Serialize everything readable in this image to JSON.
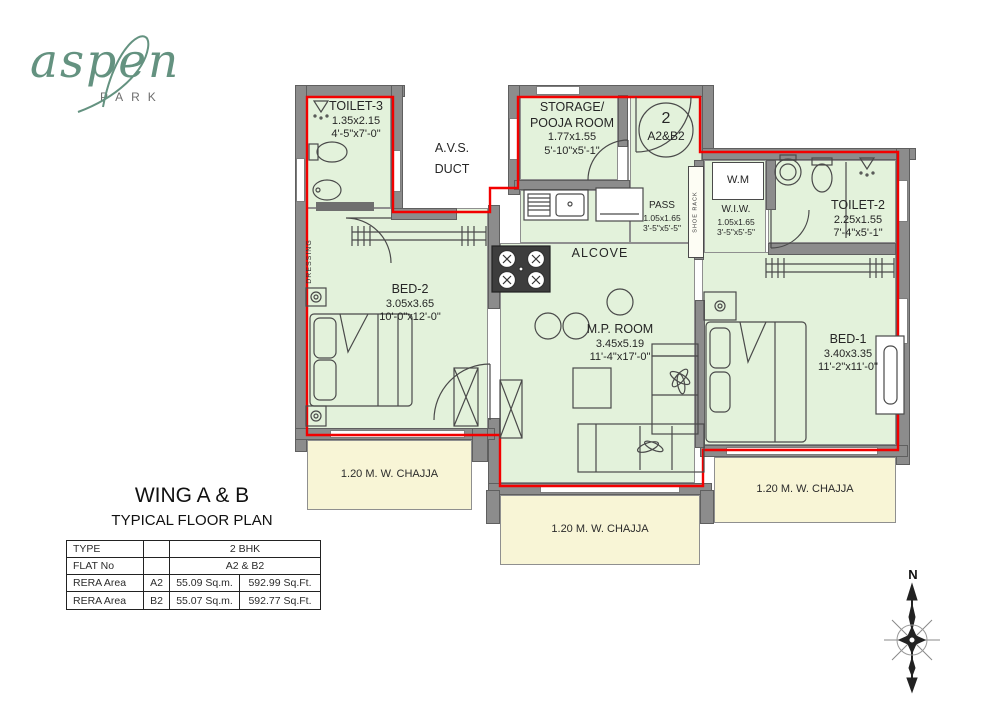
{
  "logo": {
    "brand": "aspen",
    "sub": "PARK"
  },
  "plan": {
    "toilet3": {
      "name": "TOILET-3",
      "m": "1.35x2.15",
      "ft": "4'-5\"x7'-0\""
    },
    "duct": {
      "l1": "A.V.S.",
      "l2": "DUCT"
    },
    "storage": {
      "l1": "STORAGE/",
      "l2": "POOJA ROOM",
      "m": "1.77x1.55",
      "ft": "5'-10\"x5'-1\""
    },
    "marker": {
      "num": "2",
      "flats": "A2&B2"
    },
    "pass": {
      "name": "PASS",
      "m": "1.05x1.65",
      "ft": "3'-5\"x5'-5\""
    },
    "wm": {
      "name": "W.M"
    },
    "wiw": {
      "name": "W.I.W.",
      "m": "1.05x1.65",
      "ft": "3'-5\"x5'-5\""
    },
    "toilet2": {
      "name": "TOILET-2",
      "m": "2.25x1.55",
      "ft": "7'-4\"x5'-1\""
    },
    "alcove": {
      "name": "ALCOVE"
    },
    "bed2": {
      "name": "BED-2",
      "m": "3.05x3.65",
      "ft": "10'-0\"x12'-0\""
    },
    "mp": {
      "name": "M.P. ROOM",
      "m": "3.45x5.19",
      "ft": "11'-4\"x17'-0\""
    },
    "bed1": {
      "name": "BED-1",
      "m": "3.40x3.35",
      "ft": "11'-2\"x11'-0\""
    },
    "dressing": "DRESSING",
    "shoe_rack": "SHOE RACK",
    "chajja": "1.20 M. W. CHAJJA"
  },
  "title": {
    "line1": "WING A & B",
    "line2": "TYPICAL FLOOR PLAN"
  },
  "info_table": {
    "rows": [
      {
        "c1": "TYPE",
        "c2": "",
        "c3": "2 BHK",
        "c4": ""
      },
      {
        "c1": "FLAT No",
        "c2": "",
        "c3": "A2 & B2",
        "c4": ""
      },
      {
        "c1": "RERA Area",
        "c2": "A2",
        "c3": "55.09 Sq.m.",
        "c4": "592.99 Sq.Ft."
      },
      {
        "c1": "RERA Area",
        "c2": "B2",
        "c3": "55.07 Sq.m.",
        "c4": "592.77 Sq.Ft."
      }
    ]
  },
  "compass": {
    "north": "N"
  },
  "colors": {
    "room_fill": "#e3f2db",
    "chajja_fill": "#f8f5d6",
    "wall": "#8c8c8c",
    "rera_line": "#ff0000",
    "logo_green": "#649280"
  }
}
